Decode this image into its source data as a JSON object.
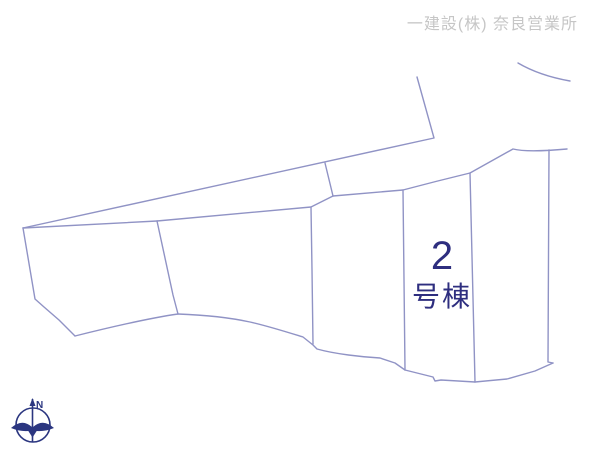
{
  "header": {
    "company_label": "一建設(株) 奈良営業所"
  },
  "plot_highlight": {
    "number": "2",
    "suffix": "号棟"
  },
  "compass": {
    "north_label": "N"
  },
  "colors": {
    "boundary_line": "#9093c5",
    "highlight_fill": "#f6cf8f",
    "highlight_text": "#2e2e7f",
    "header_text": "#c6c6c6",
    "compass": "#2b3680",
    "background": "#ffffff"
  }
}
